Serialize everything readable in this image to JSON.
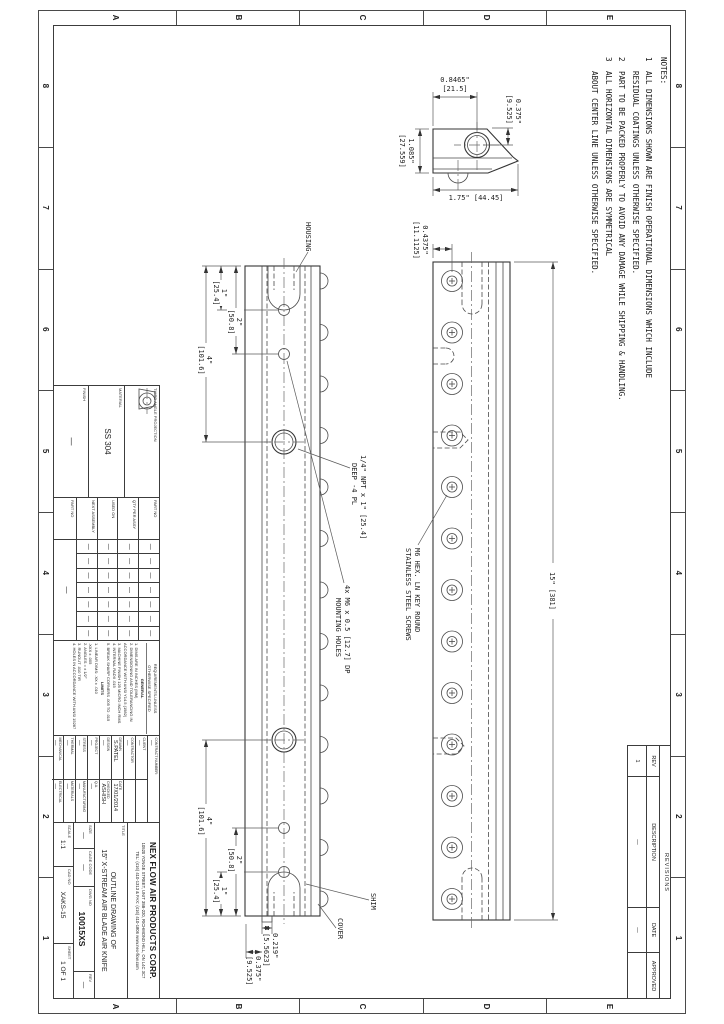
{
  "zones": {
    "cols": [
      "8",
      "7",
      "6",
      "5",
      "4",
      "3",
      "2",
      "1"
    ],
    "rows": [
      "E",
      "D",
      "C",
      "B",
      "A"
    ]
  },
  "notes": {
    "title": "NOTES:",
    "items": [
      {
        "num": "1",
        "line1": "ALL DIMENSIONS SHOWN ARE FINISH OPERATIONAL DIMENSIONS WHICH INCLUDE",
        "line2": "RESIDUAL COATINGS UNLESS OTHERWISE SPECIFIED."
      },
      {
        "num": "2",
        "line1": "PART TO BE PACKED PROPERLY TO AVOID ANY DAMAGE WHILE SHIPPING & HANDLING.",
        "line2": ""
      },
      {
        "num": "3",
        "line1": "ALL HORIZONTAL DIMENSIONS ARE SYMMETRICAL",
        "line2": "ABOUT CENTER LINE UNLESS OTHERWISE SPECIFIED."
      }
    ]
  },
  "front_view": {
    "length_dim": "15\" [381]",
    "offset": "0.4375\"",
    "offset_mm": "[11.1125]",
    "screw_note1": "M6 HEX. LN KEY ROUND",
    "screw_note2": "STAINLESS STEEL SCREWS"
  },
  "section_view": {
    "housing": "HOUSING",
    "shim": "SHIM",
    "cover": "COVER",
    "d1": "1\"",
    "d1mm": "[25.4]",
    "d2": "2\"",
    "d2mm": "[50.8]",
    "d4": "4\"",
    "d4mm": "[101.6]",
    "step1": "0.219\"",
    "step1mm": "[5.5623]",
    "step2": "0.375\"",
    "step2mm": "[9.525]",
    "npt1": "1/4\" NPT x 1\" [25.4]",
    "npt2": "DEEP  -4 PL",
    "mount1": "4x  M6 x 0.5 [12.7] DP",
    "mount2": "MOUNTING HOLES"
  },
  "end_view": {
    "w1": "0.8465\"",
    "w1mm": "[21.5]",
    "h1": "0.375\"",
    "h1mm": "[9.525]",
    "h2": "1.085\"",
    "h2mm": "[27.559]",
    "w2": "1.75\" [44.45]"
  },
  "revisions": {
    "title": "REVISIONS",
    "headers": [
      "REV",
      "DESCRIPTION",
      "DATE",
      "APPROVED"
    ],
    "row": [
      "1",
      "—",
      "—",
      ""
    ]
  },
  "title_block": {
    "projection": {
      "label": "THIRD ANGLE PROJECTION"
    },
    "material": {
      "label": "MATERIAL",
      "value": "SS 304"
    },
    "finish": {
      "label": "FINISH",
      "value": "—"
    },
    "application": {
      "row_labels": [
        "PART NO",
        "QTY PER ASSY",
        "USED ON",
        "NEXT ASSEMBLY"
      ],
      "cell": "—",
      "part_no_label": "PART NO",
      "part_no_value": "—"
    },
    "requirements": {
      "header1": "REQUIREMENTS-UNLESS",
      "header2": "OTHERWISE SPECIFIED",
      "general_title": "GENERAL",
      "general": [
        "1. DIMS ARE IN INCHES (MM)",
        "2. DIMENSIONING AND TOLERANCING IN",
        "   ACCORDANCE WITH ANSI Y14.5 (1982)",
        "3. MACHINE FINISH 125 MICRO INCH RMS",
        "4. INTERNAL RADII .015",
        "5. BREAK SHARP CORNERS .005 TO .015"
      ],
      "limits_title": "LIMITS",
      "limits": [
        "1. LINEAR DIMS:  .XX ± .010",
        "                 .XXX ± .005",
        "2. ANGLES = ± 1/2°",
        "3. RUNOUT .010 TIR",
        "4. HOLES IN ACCORDANCE WITH ANSI 15287"
      ]
    },
    "signoff": {
      "contract_label": "CONTRACT NUMBER:",
      "contract_value": "—",
      "rows": [
        {
          "l": "CLIENT",
          "v": "—",
          "l2": "",
          "v2": ""
        },
        {
          "l": "CONTRACTOR",
          "v": "—",
          "l2": "",
          "v2": ""
        },
        {
          "l": "DRAWN",
          "v": "S.PATEL",
          "l2": "DATE",
          "v2": "17/01/2014"
        },
        {
          "l": "DESIGN",
          "v": "—",
          "l2": "CHECKED",
          "v2": "ASHISH"
        },
        {
          "l": "PROJECT",
          "v": "—",
          "l2": "Q.A.",
          "v2": "—"
        },
        {
          "l": "STRESS",
          "v": "—",
          "l2": "MANUFACTURING",
          "v2": "—"
        },
        {
          "l": "THERMAL",
          "v": "—",
          "l2": "MATERIALS",
          "v2": "—"
        },
        {
          "l": "MECHANICAL",
          "v": "—",
          "l2": "ELECTRICAL",
          "v2": "—"
        }
      ]
    },
    "company": {
      "name": "NEX FLOW AIR PRODUCTS CORP.",
      "address": "10520 YONGE STREET, UNIT 35B-220, RICHMOND HILL, ON L4C 3C7",
      "tel": "TEL: (416) 410-1313 & FAX: (416) 410-1806   www.nex-flow.com"
    },
    "title_area": {
      "label": "TITLE",
      "line1": "OUTLINE DRAWING OF",
      "line2": "15\" X-STREAM AIR BLADE AIR KNIFE"
    },
    "fields": {
      "size_label": "SIZE",
      "size": "—",
      "cage_label": "CAGE CODE",
      "cage": "—",
      "dwg_label": "DWG NO",
      "dwg": "10015XS",
      "rev_label": "REV",
      "rev": "—",
      "scale_label": "SCALE",
      "scale": "1:1",
      "cad_label": "CAD NO",
      "cad": "XAKS-15",
      "sheet_label": "SHEET",
      "sheet": "1 OF 1"
    }
  }
}
